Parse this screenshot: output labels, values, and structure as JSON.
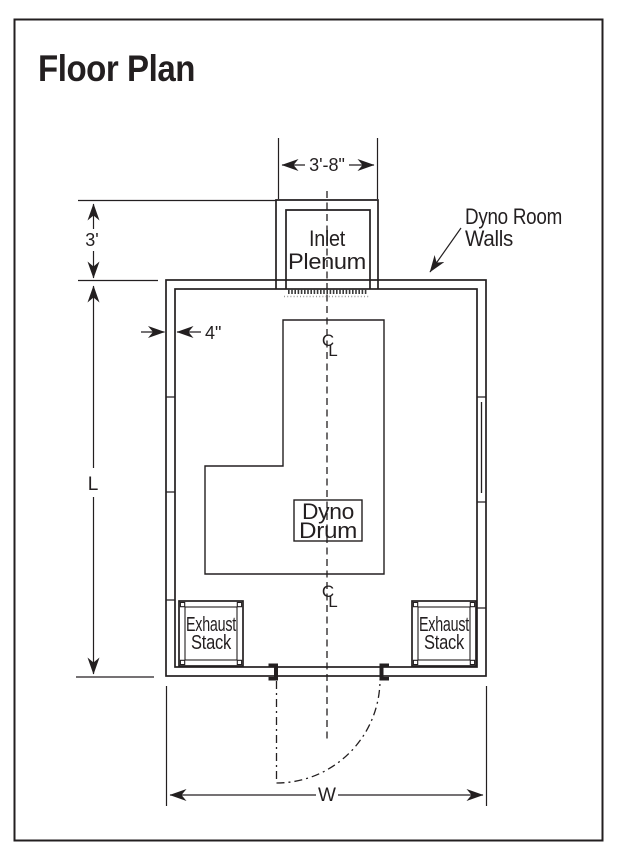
{
  "page": {
    "title": "Floor Plan"
  },
  "colors": {
    "accent_red": "#E31837",
    "line": "#231F20"
  },
  "labels": {
    "inlet_plenum": [
      "Inlet",
      "Plenum"
    ],
    "dyno_room_walls": [
      "Dyno Room",
      "Walls"
    ],
    "dyno_drum": [
      "Dyno",
      "Drum"
    ],
    "exhaust_stack": [
      "Exhaust",
      "Stack"
    ]
  },
  "dimensions": {
    "plenum_width": "3'-8\"",
    "plenum_setback": "3'",
    "wall_thickness": "4\"",
    "room_length": "L",
    "room_width": "W"
  },
  "symbols": {
    "centerline": [
      "C",
      "L"
    ]
  }
}
